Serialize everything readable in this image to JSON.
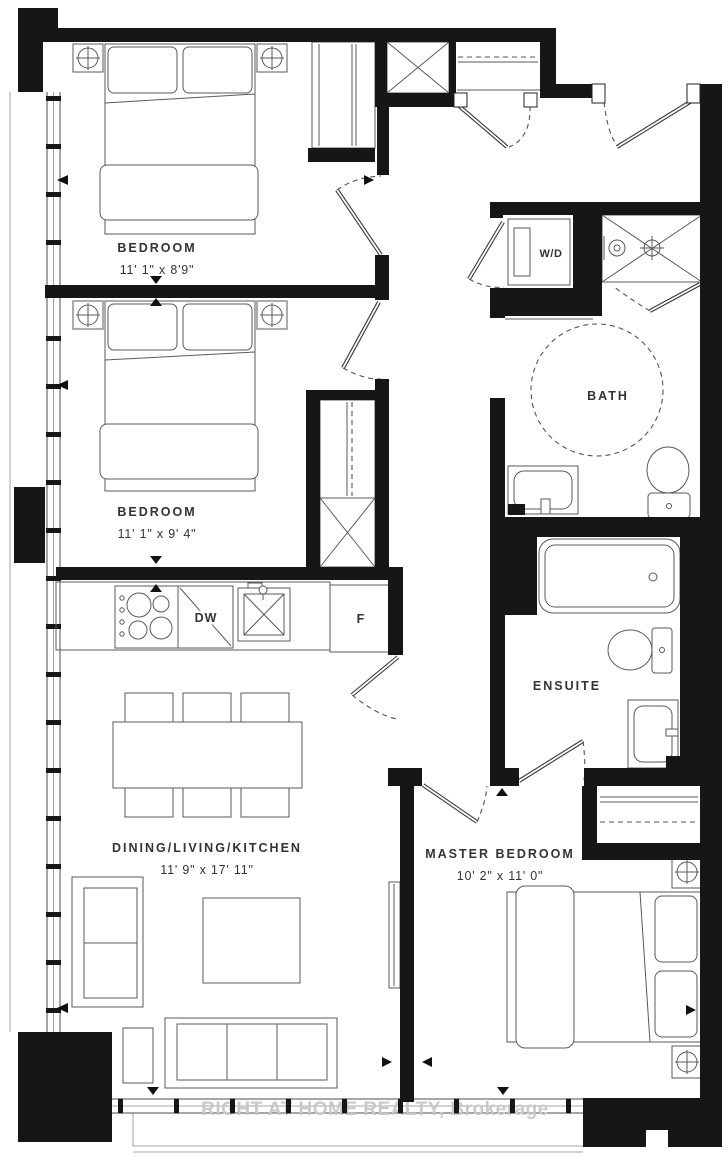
{
  "rooms": {
    "bedroom1": {
      "label": "BEDROOM",
      "dims": "11' 1\" x 8'9\""
    },
    "bedroom2": {
      "label": "BEDROOM",
      "dims": "11' 1\" x 9' 4\""
    },
    "living": {
      "label": "DINING/LIVING/KITCHEN",
      "dims": "11' 9\" x 17' 11\""
    },
    "master": {
      "label": "MASTER BEDROOM",
      "dims": "10' 2\" x 11' 0\""
    },
    "bath": {
      "label": "BATH"
    },
    "ensuite": {
      "label": "ENSUITE"
    }
  },
  "fixtures": {
    "washer_dryer": "W/D",
    "dishwasher": "DW",
    "fridge": "F"
  },
  "watermark": "RIGHT AT HOME REALTY, Brokerage",
  "colors": {
    "wall": "#161616",
    "line": "#4d4d4d",
    "text": "#333333",
    "watermark": "#c6c6c6",
    "background": "#ffffff"
  }
}
